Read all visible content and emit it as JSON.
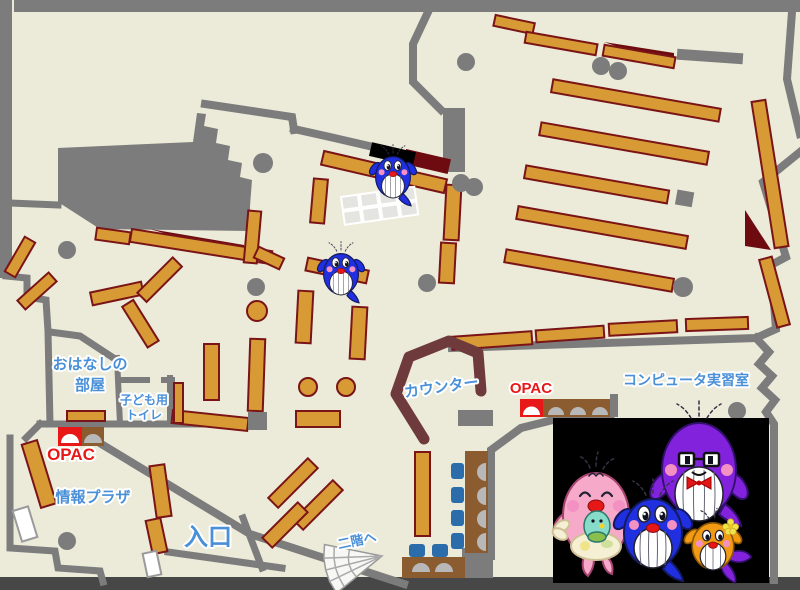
{
  "map": {
    "labels": {
      "story_room_line1": "おはなしの",
      "story_room_line2": "部屋",
      "kids_toilet_line1": "子ども用",
      "kids_toilet_line2": "トイレ",
      "opac_left": "OPAC",
      "opac_right": "OPAC",
      "info_plaza": "情報プラザ",
      "entrance": "入口",
      "counter": "カウンター",
      "computer_room": "コンピュータ実習室",
      "to_second_floor": "二階へ"
    },
    "colors": {
      "floor": "#ecead9",
      "wall": "#7c7c7c",
      "wall_dark": "#474747",
      "shelf": "#d79a35",
      "shelf_border": "#7a1416",
      "dark_red": "#6e0b10",
      "counter": "#6e3a3c",
      "label_blue": "#4a90d8",
      "label_red": "#e81818",
      "desk_brown": "#8a5c30",
      "chair_blue": "#2b6cab",
      "monitor_gray": "#b8b8b8",
      "table_cell": "#e4e4e0",
      "stairs_fill": "#f7f7f4",
      "photo_bg": "#000000",
      "white_piece": "#ffffff",
      "whale_blue": "#2030e0",
      "whale_purple": "#8322dd",
      "whale_pink": "#f6a9c9",
      "whale_orange": "#f29a13",
      "baby_teal": "#86dcc9",
      "cheek_pink": "#f291c2",
      "mouth_red": "#e61717",
      "flower_yellow": "#f3e34a",
      "apron_cream": "#f5efd4"
    }
  }
}
